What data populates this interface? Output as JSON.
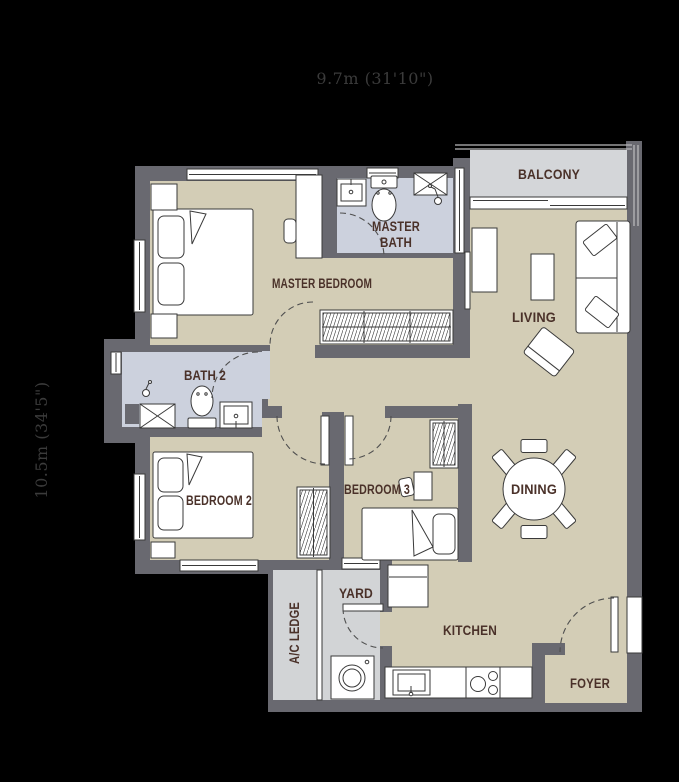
{
  "dimensions": {
    "width_label": "9.7m (31'10\")",
    "height_label": "10.5m (34'5\")"
  },
  "rooms": {
    "balcony": "BALCONY",
    "living": "LIVING",
    "master_bath_line1": "MASTER",
    "master_bath_line2": "BATH",
    "master_bedroom": "MASTER BEDROOM",
    "bath2": "BATH 2",
    "bedroom2": "BEDROOM 2",
    "bedroom3": "BEDROOM 3",
    "dining": "DINING",
    "kitchen": "KITCHEN",
    "yard": "YARD",
    "ac_ledge": "A/C LEDGE",
    "foyer": "FOYER"
  },
  "colors": {
    "background": "#000000",
    "wall": "#696970",
    "floor": "#d3cdb6",
    "bathroom_floor": "#ccd1dd",
    "balcony_floor": "#d4d6d9",
    "service_floor": "#d2d4d6",
    "fixture": "#ffffff",
    "label": "#4a3129",
    "dimension_text": "#3b3b3b"
  }
}
